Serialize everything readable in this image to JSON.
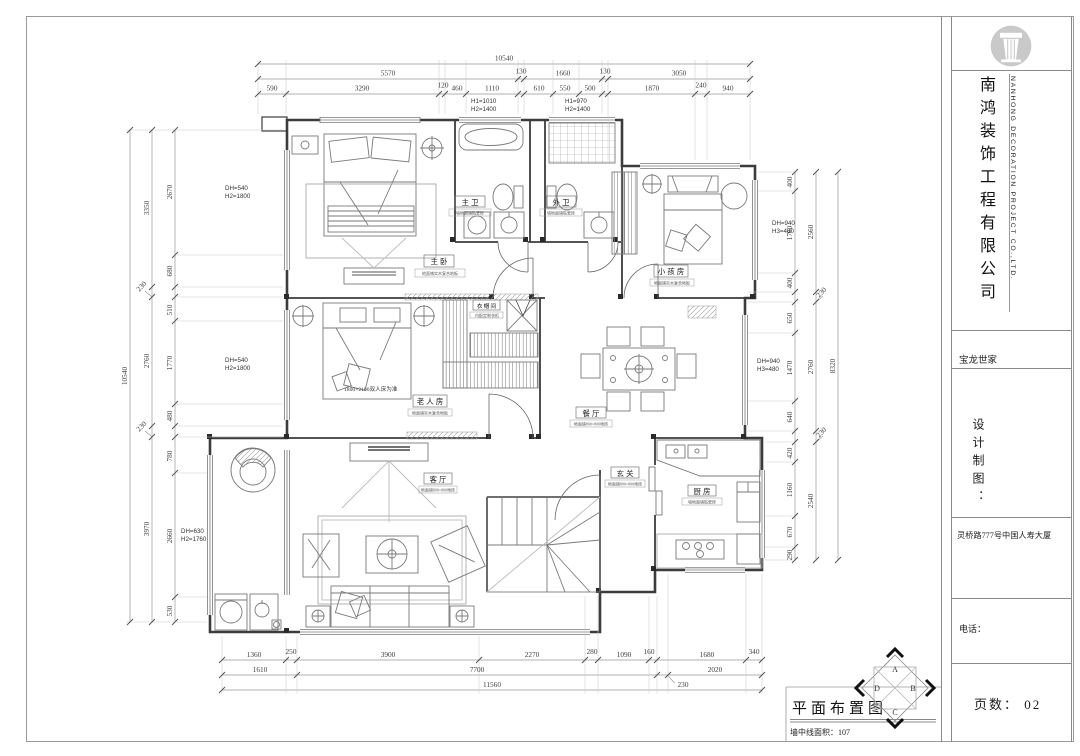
{
  "title_block": {
    "company_cn": "南鸿装饰工程有限公司",
    "company_en": "NANHONG DECORATION PROJECT CO.,LTD.",
    "project": "宝龙世家",
    "design_label": "设计制图：",
    "address": "灵桥路777号中国人寿大厦",
    "phone_label": "电话：",
    "page_label": "页数：",
    "page_value": "02"
  },
  "footer": {
    "drawing_title": "平面布置图",
    "area_note": "墙中线面积：107"
  },
  "compass": {
    "top": "A",
    "right": "B",
    "bottom": "C",
    "left": "D"
  },
  "dims": {
    "top": {
      "total": "10540",
      "r2": [
        "5570",
        "130",
        "1660",
        "130",
        "3050"
      ],
      "r3": [
        "590",
        "3290",
        "120",
        "460",
        "1110",
        "610",
        "550",
        "500",
        "1870",
        "240",
        "940"
      ]
    },
    "bottom": {
      "total": "11560",
      "r1": [
        "1360",
        "250",
        "3900",
        "2270",
        "280",
        "1090",
        "160",
        "1680",
        "340"
      ],
      "r2": [
        "1610",
        "7700",
        "230",
        "2020"
      ]
    },
    "left": {
      "total": "10540",
      "mid": [
        "3350",
        "230",
        "2760",
        "230",
        "3970"
      ],
      "inner": [
        "2670",
        "680",
        "510",
        "1770",
        "480",
        "780",
        "2660",
        "530"
      ]
    },
    "right": {
      "total": "8320",
      "mid": [
        "2560",
        "230",
        "2760",
        "230",
        "2540"
      ],
      "inner": [
        "400",
        "1760",
        "400",
        "650",
        "1470",
        "640",
        "420",
        "1160",
        "670",
        "290"
      ]
    }
  },
  "annotations": {
    "win_top_left": {
      "l1": "H1=1010",
      "l2": "H2=1400"
    },
    "win_top_right": {
      "l1": "H1=970",
      "l2": "H2=1400"
    },
    "bay_left_top": {
      "l1": "DH=540",
      "l2": "H2=1800"
    },
    "bay_left_bottom": {
      "l1": "DH=540",
      "l2": "H2=1800"
    },
    "bay_balcony": {
      "l1": "DH=630",
      "l2": "H2=1760"
    },
    "bay_right_top": {
      "l1": "DH=940",
      "l2": "H3=480"
    },
    "bay_right_mid": {
      "l1": "DH=940",
      "l2": "H3=480"
    },
    "bed_note": "1800×2100双人床为准"
  },
  "rooms": {
    "master": {
      "name": "主卧",
      "caption": "地面铺实木复合地板"
    },
    "master_bath": {
      "name": "主卫",
      "caption": "墙地面铺贴瓷砖"
    },
    "guest_bath": {
      "name": "外卫",
      "caption": "墙地面铺贴瓷砖"
    },
    "kids": {
      "name": "小孩房",
      "caption": "地面铺实木复合地板"
    },
    "closet": {
      "name": "衣帽间",
      "caption": "内配定制衣柜"
    },
    "elder": {
      "name": "老人房",
      "caption": "地面铺实木复合地板"
    },
    "dining": {
      "name": "餐厅",
      "caption": "地面铺800×800地砖"
    },
    "living": {
      "name": "客厅",
      "caption": "地面铺800×800地砖"
    },
    "entry": {
      "name": "玄关",
      "caption": "地面铺800×800地砖"
    },
    "kitchen": {
      "name": "厨房",
      "caption": "墙地面铺贴瓷砖"
    }
  }
}
